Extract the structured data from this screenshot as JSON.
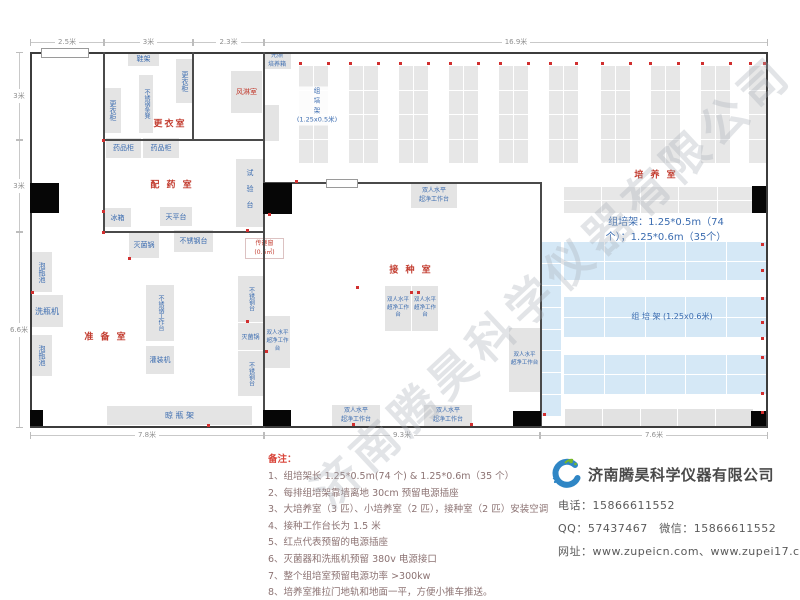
{
  "watermark": {
    "text": "济南腾昊科学仪器有限公司"
  },
  "dims": {
    "top": [
      {
        "label": "2.5米",
        "x": 30,
        "w": 74
      },
      {
        "label": "3米",
        "x": 104,
        "w": 89
      },
      {
        "label": "2.3米",
        "x": 193,
        "w": 71
      },
      {
        "label": "16.9米",
        "x": 264,
        "w": 504
      }
    ],
    "bottom": [
      {
        "label": "7.8米",
        "x": 30,
        "w": 234
      },
      {
        "label": "9.3米",
        "x": 264,
        "w": 276
      },
      {
        "label": "7.6米",
        "x": 540,
        "w": 228
      }
    ],
    "left": [
      {
        "label": "3米",
        "y": 52,
        "h": 88
      },
      {
        "label": "3米",
        "y": 140,
        "h": 92
      },
      {
        "label": "6.6米",
        "y": 232,
        "h": 196
      }
    ]
  },
  "plan": {
    "walls": [
      {
        "x": 103,
        "y": 52,
        "w": 2,
        "h": 180
      },
      {
        "x": 103,
        "y": 139,
        "w": 162,
        "h": 2
      },
      {
        "x": 192,
        "y": 52,
        "w": 2,
        "h": 88
      },
      {
        "x": 103,
        "y": 231,
        "w": 162,
        "h": 2
      },
      {
        "x": 263,
        "y": 52,
        "w": 2,
        "h": 376
      },
      {
        "x": 263,
        "y": 182,
        "w": 279,
        "h": 2
      },
      {
        "x": 540,
        "y": 183,
        "w": 2,
        "h": 245
      }
    ],
    "windows": [
      {
        "x": 41,
        "y": 48,
        "w": 46,
        "h": 8
      },
      {
        "x": 326,
        "y": 179,
        "w": 30,
        "h": 7
      }
    ],
    "doors": [
      {
        "x": 30,
        "y": 183,
        "w": 29,
        "h": 30
      },
      {
        "x": 263,
        "y": 183,
        "w": 29,
        "h": 31
      },
      {
        "x": 30,
        "y": 410,
        "w": 13,
        "h": 16
      },
      {
        "x": 263,
        "y": 410,
        "w": 28,
        "h": 16
      },
      {
        "x": 513,
        "y": 411,
        "w": 28,
        "h": 15
      },
      {
        "x": 751,
        "y": 411,
        "w": 15,
        "h": 15
      },
      {
        "x": 752,
        "y": 186,
        "w": 14,
        "h": 27
      }
    ],
    "room_labels": [
      {
        "text": "更衣室",
        "cx": 170,
        "cy": 123
      },
      {
        "text": "配 药 室",
        "cx": 172,
        "cy": 184
      },
      {
        "text": "准 备 室",
        "cx": 106,
        "cy": 336
      },
      {
        "text": "接 种 室",
        "cx": 411,
        "cy": 269
      },
      {
        "text": "培 养 室",
        "cx": 656,
        "cy": 174
      }
    ],
    "rack_grids": [
      {
        "x": 299,
        "y": 66,
        "w": 29,
        "h": 97,
        "cols": 2,
        "rows": 4,
        "fill": "#e7e7e7"
      },
      {
        "x": 349,
        "y": 66,
        "w": 29,
        "h": 97,
        "cols": 2,
        "rows": 4,
        "fill": "#e7e7e7"
      },
      {
        "x": 399,
        "y": 66,
        "w": 29,
        "h": 97,
        "cols": 2,
        "rows": 4,
        "fill": "#e7e7e7"
      },
      {
        "x": 449,
        "y": 66,
        "w": 29,
        "h": 97,
        "cols": 2,
        "rows": 4,
        "fill": "#e7e7e7"
      },
      {
        "x": 499,
        "y": 66,
        "w": 29,
        "h": 97,
        "cols": 2,
        "rows": 4,
        "fill": "#e7e7e7"
      },
      {
        "x": 549,
        "y": 66,
        "w": 29,
        "h": 97,
        "cols": 2,
        "rows": 4,
        "fill": "#e7e7e7"
      },
      {
        "x": 601,
        "y": 66,
        "w": 29,
        "h": 97,
        "cols": 2,
        "rows": 4,
        "fill": "#e7e7e7"
      },
      {
        "x": 651,
        "y": 66,
        "w": 29,
        "h": 97,
        "cols": 2,
        "rows": 4,
        "fill": "#e7e7e7"
      },
      {
        "x": 701,
        "y": 66,
        "w": 29,
        "h": 97,
        "cols": 2,
        "rows": 4,
        "fill": "#e7e7e7"
      },
      {
        "x": 749,
        "y": 66,
        "w": 17,
        "h": 97,
        "cols": 1,
        "rows": 4,
        "fill": "#e7e7e7"
      },
      {
        "x": 564,
        "y": 187,
        "w": 191,
        "h": 26,
        "cols": 5,
        "rows": 2,
        "fill": "#e7e7e7"
      },
      {
        "x": 541,
        "y": 242,
        "w": 20,
        "h": 174,
        "cols": 1,
        "rows": 8,
        "fill": "#d5e8f6"
      },
      {
        "x": 564,
        "y": 242,
        "w": 203,
        "h": 38,
        "cols": 5,
        "rows": 2,
        "fill": "#d5e8f6"
      },
      {
        "x": 564,
        "y": 297,
        "w": 203,
        "h": 40,
        "cols": 5,
        "rows": 2,
        "fill": "#d5e8f6"
      },
      {
        "x": 564,
        "y": 355,
        "w": 203,
        "h": 39,
        "cols": 5,
        "rows": 2,
        "fill": "#d5e8f6"
      },
      {
        "x": 565,
        "y": 409,
        "w": 188,
        "h": 17,
        "cols": 5,
        "rows": 1,
        "fill": "#e2e2e2"
      }
    ],
    "rack_labels": [
      {
        "text": "组\n培\n架\n(1.25x0.5米)",
        "cx": 317,
        "cy": 106,
        "fs": 6.5,
        "bg": true
      },
      {
        "text": "组培架：1.25*0.5m（74个）；1.25*0.6m（35个）",
        "cx": 666,
        "cy": 230,
        "fs": 10,
        "bg": false
      },
      {
        "text": "组  培  架 (1.25x0.6米)",
        "cx": 672,
        "cy": 317,
        "fs": 8,
        "bg": false
      }
    ],
    "equipment": [
      {
        "label": "鞋架",
        "x": 128,
        "y": 52,
        "w": 31,
        "h": 14,
        "mode": "h"
      },
      {
        "label": "更衣柜",
        "x": 176,
        "y": 59,
        "w": 17,
        "h": 44,
        "mode": "v"
      },
      {
        "label": "不锈钢条凳",
        "x": 139,
        "y": 75,
        "w": 14,
        "h": 58,
        "mode": "v",
        "fs": 6
      },
      {
        "label": "更衣柜",
        "x": 104,
        "y": 88,
        "w": 17,
        "h": 45,
        "mode": "v"
      },
      {
        "label": "风淋室",
        "x": 231,
        "y": 71,
        "w": 31,
        "h": 42,
        "mode": "h",
        "color": "#c23b2e"
      },
      {
        "label": "光照\n培养箱",
        "x": 263,
        "y": 52,
        "w": 28,
        "h": 17,
        "mode": "ml",
        "fs": 6
      },
      {
        "label": "",
        "x": 263,
        "y": 105,
        "w": 16,
        "h": 36,
        "mode": "none"
      },
      {
        "label": "药品柜",
        "x": 106,
        "y": 138,
        "w": 35,
        "h": 20,
        "mode": "h"
      },
      {
        "label": "药品柜",
        "x": 143,
        "y": 138,
        "w": 36,
        "h": 20,
        "mode": "h"
      },
      {
        "label": "试验台",
        "x": 236,
        "y": 159,
        "w": 27,
        "h": 68,
        "mode": "v",
        "ls": 9
      },
      {
        "label": "冰箱",
        "x": 104,
        "y": 208,
        "w": 27,
        "h": 19,
        "mode": "h"
      },
      {
        "label": "天平台",
        "x": 160,
        "y": 207,
        "w": 32,
        "h": 19,
        "mode": "h"
      },
      {
        "label": "泡瓶池",
        "x": 31,
        "y": 252,
        "w": 21,
        "h": 40,
        "mode": "v"
      },
      {
        "label": "洗瓶机",
        "x": 31,
        "y": 295,
        "w": 32,
        "h": 32,
        "mode": "h",
        "fs": 8
      },
      {
        "label": "泡瓶池",
        "x": 31,
        "y": 335,
        "w": 21,
        "h": 41,
        "mode": "v"
      },
      {
        "label": "灭菌锅",
        "x": 129,
        "y": 231,
        "w": 30,
        "h": 27,
        "mode": "h"
      },
      {
        "label": "不锈钢台",
        "x": 174,
        "y": 230,
        "w": 39,
        "h": 22,
        "mode": "h"
      },
      {
        "label": "不锈钢工作台",
        "x": 146,
        "y": 285,
        "w": 28,
        "h": 56,
        "mode": "v",
        "fs": 6
      },
      {
        "label": "灌装机",
        "x": 146,
        "y": 346,
        "w": 28,
        "h": 28,
        "mode": "h"
      },
      {
        "label": "不锈钢台",
        "x": 238,
        "y": 276,
        "w": 25,
        "h": 46,
        "mode": "v",
        "fs": 6
      },
      {
        "label": "灭菌锅",
        "x": 238,
        "y": 323,
        "w": 25,
        "h": 27,
        "mode": "h",
        "fs": 6
      },
      {
        "label": "不锈钢台",
        "x": 238,
        "y": 351,
        "w": 25,
        "h": 45,
        "mode": "v",
        "fs": 6
      },
      {
        "label": "晾  瓶  架",
        "x": 107,
        "y": 406,
        "w": 145,
        "h": 19,
        "mode": "h",
        "fs": 8
      },
      {
        "label": "双人水平\n超净工作台",
        "x": 411,
        "y": 184,
        "w": 46,
        "h": 24,
        "mode": "ml",
        "fs": 6
      },
      {
        "label": "双人水平\n超净工作台",
        "x": 385,
        "y": 286,
        "w": 26,
        "h": 45,
        "mode": "ml",
        "fs": 5.5
      },
      {
        "label": "双人水平\n超净工作台",
        "x": 412,
        "y": 286,
        "w": 26,
        "h": 45,
        "mode": "ml",
        "fs": 5.5
      },
      {
        "label": "双人水平\n超净工作台",
        "x": 265,
        "y": 316,
        "w": 25,
        "h": 52,
        "mode": "ml",
        "fs": 5.5
      },
      {
        "label": "双人水平\n超净工作台",
        "x": 509,
        "y": 328,
        "w": 31,
        "h": 64,
        "mode": "ml",
        "fs": 5.5
      },
      {
        "label": "双人水平\n超净工作台",
        "x": 332,
        "y": 405,
        "w": 48,
        "h": 21,
        "mode": "ml",
        "fs": 6
      },
      {
        "label": "双人水平\n超净工作台",
        "x": 424,
        "y": 405,
        "w": 48,
        "h": 21,
        "mode": "ml",
        "fs": 6
      },
      {
        "label": "传递窗\n(0.6㎡)",
        "x": 245,
        "y": 238,
        "w": 37,
        "h": 19,
        "mode": "ml",
        "fs": 6,
        "color": "#c23b2e",
        "fill": "#ffffff",
        "border": "#dcc2c2"
      }
    ],
    "power_dots": [
      [
        299,
        62
      ],
      [
        327,
        62
      ],
      [
        349,
        62
      ],
      [
        377,
        62
      ],
      [
        399,
        62
      ],
      [
        427,
        62
      ],
      [
        449,
        62
      ],
      [
        477,
        62
      ],
      [
        499,
        62
      ],
      [
        527,
        62
      ],
      [
        549,
        62
      ],
      [
        575,
        62
      ],
      [
        601,
        62
      ],
      [
        629,
        62
      ],
      [
        649,
        62
      ],
      [
        677,
        62
      ],
      [
        701,
        62
      ],
      [
        729,
        62
      ],
      [
        749,
        62
      ],
      [
        763,
        62
      ],
      [
        761,
        243
      ],
      [
        761,
        269
      ],
      [
        761,
        297
      ],
      [
        761,
        321
      ],
      [
        761,
        337
      ],
      [
        761,
        356
      ],
      [
        761,
        392
      ],
      [
        761,
        411
      ],
      [
        102,
        210
      ],
      [
        246,
        229
      ],
      [
        295,
        180
      ],
      [
        268,
        213
      ],
      [
        102,
        139
      ],
      [
        410,
        291
      ],
      [
        417,
        291
      ],
      [
        352,
        423
      ],
      [
        470,
        423
      ],
      [
        543,
        413
      ],
      [
        31,
        291
      ],
      [
        246,
        320
      ],
      [
        265,
        350
      ],
      [
        207,
        424
      ],
      [
        102,
        231
      ],
      [
        128,
        257
      ],
      [
        356,
        286
      ]
    ]
  },
  "notes": {
    "title": "备注：",
    "items": [
      "1、组培架长 1.25*0.5m(74 个) & 1.25*0.6m（35 个）",
      "2、每排组培架靠墙离地 30cm 预留电源插座",
      "3、大培养室（3 匹）、小培养室（2 匹），接种室（2 匹）安装空调",
      "4、接种工作台长为 1.5 米",
      "5、红点代表预留的电源插座",
      "6、灭菌器和洗瓶机预留 380v 电源接口",
      "7、整个组培室预留电源功率 >300kw",
      "8、培养室推拉门地轨和地面一平，方便小推车推送。"
    ]
  },
  "company": {
    "name": "济南腾昊科学仪器有限公司",
    "logo_text": "TH",
    "contact_lines": [
      "电话：15866611552",
      "QQ：57437467　微信：15866611552",
      "网址：www.zupeicn.com、www.zupei17.com"
    ]
  },
  "colors": {
    "accent_red": "#c23b2e",
    "label_blue": "#3b6cb0",
    "rack_gray": "#e7e7e7",
    "rack_blue": "#d5e8f6",
    "wall": "#4a4a4a",
    "power_dot": "#d12f2f"
  }
}
